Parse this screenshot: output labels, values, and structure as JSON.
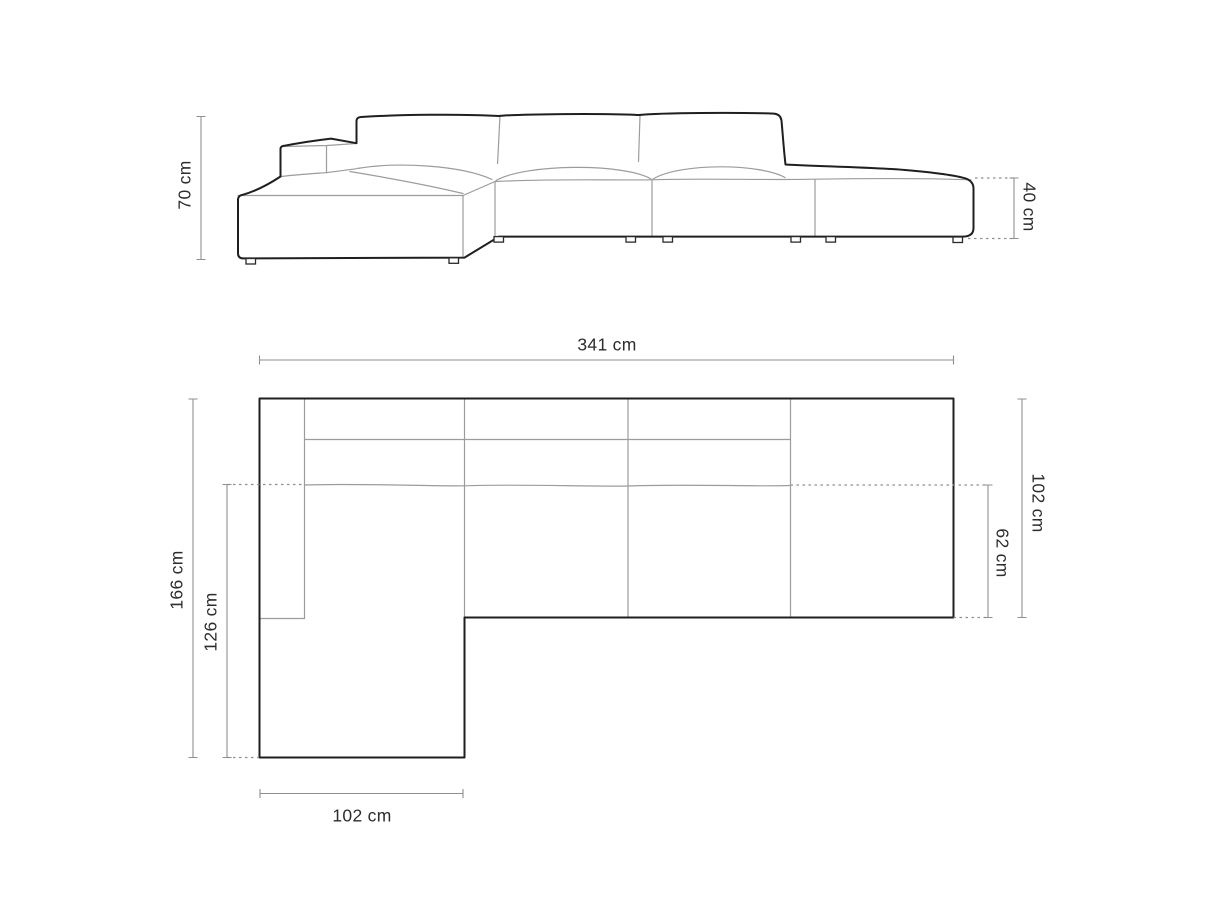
{
  "front_view": {
    "height_label": "70 cm",
    "seat_height_label": "40 cm"
  },
  "top_view": {
    "total_width_label": "341 cm",
    "total_depth_label": "102 cm",
    "seat_depth_label": "62 cm",
    "chaise_length_label": "166 cm",
    "chaise_inner_length_label": "126 cm",
    "chaise_width_label": "102 cm"
  },
  "colors": {
    "background": "#ffffff",
    "outline_strong": "#1f1f1f",
    "outline_light": "#9c9c9c",
    "dimension_line": "#8f8f8f",
    "label_text": "#2d2d2d"
  }
}
